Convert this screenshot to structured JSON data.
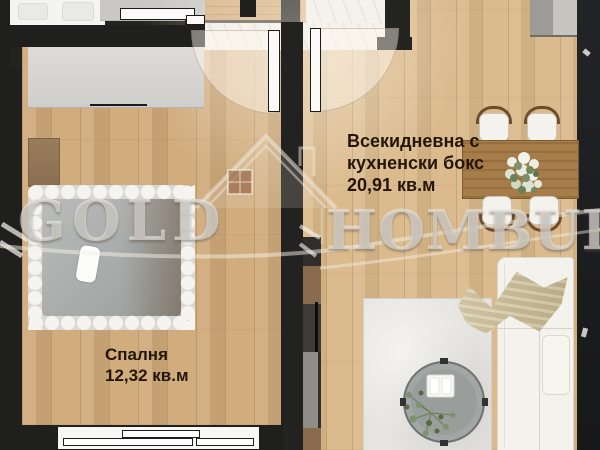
{
  "watermark": {
    "word_left": "GOLD",
    "word_right": "HOMBURG",
    "logo": "house-roof-logo"
  },
  "rooms": {
    "living_room": {
      "label_line1": "Всекидневна с",
      "label_line2": "кухненски бокс",
      "area": "20,91 кв.м"
    },
    "bedroom": {
      "label": "Спалня",
      "area": "12,32 кв.м"
    }
  },
  "colors": {
    "wall": "#1f1f1d",
    "wood_floor_bedroom": "#d0aa7a",
    "wood_floor_living": "#dab98a",
    "marble_hall": "#f1efe9",
    "label_text": "#241607",
    "watermark_text": "rgba(232,230,225,0.55)"
  },
  "furniture": {
    "bedroom": [
      "wardrobe",
      "dresser",
      "double-bed",
      "pillow",
      "window"
    ],
    "living_room": [
      "kitchen-counter",
      "dining-table",
      "dining-chairs",
      "flower-centerpiece",
      "sofa",
      "throw-blanket",
      "rug",
      "coffee-table",
      "plant",
      "tv-console"
    ]
  }
}
